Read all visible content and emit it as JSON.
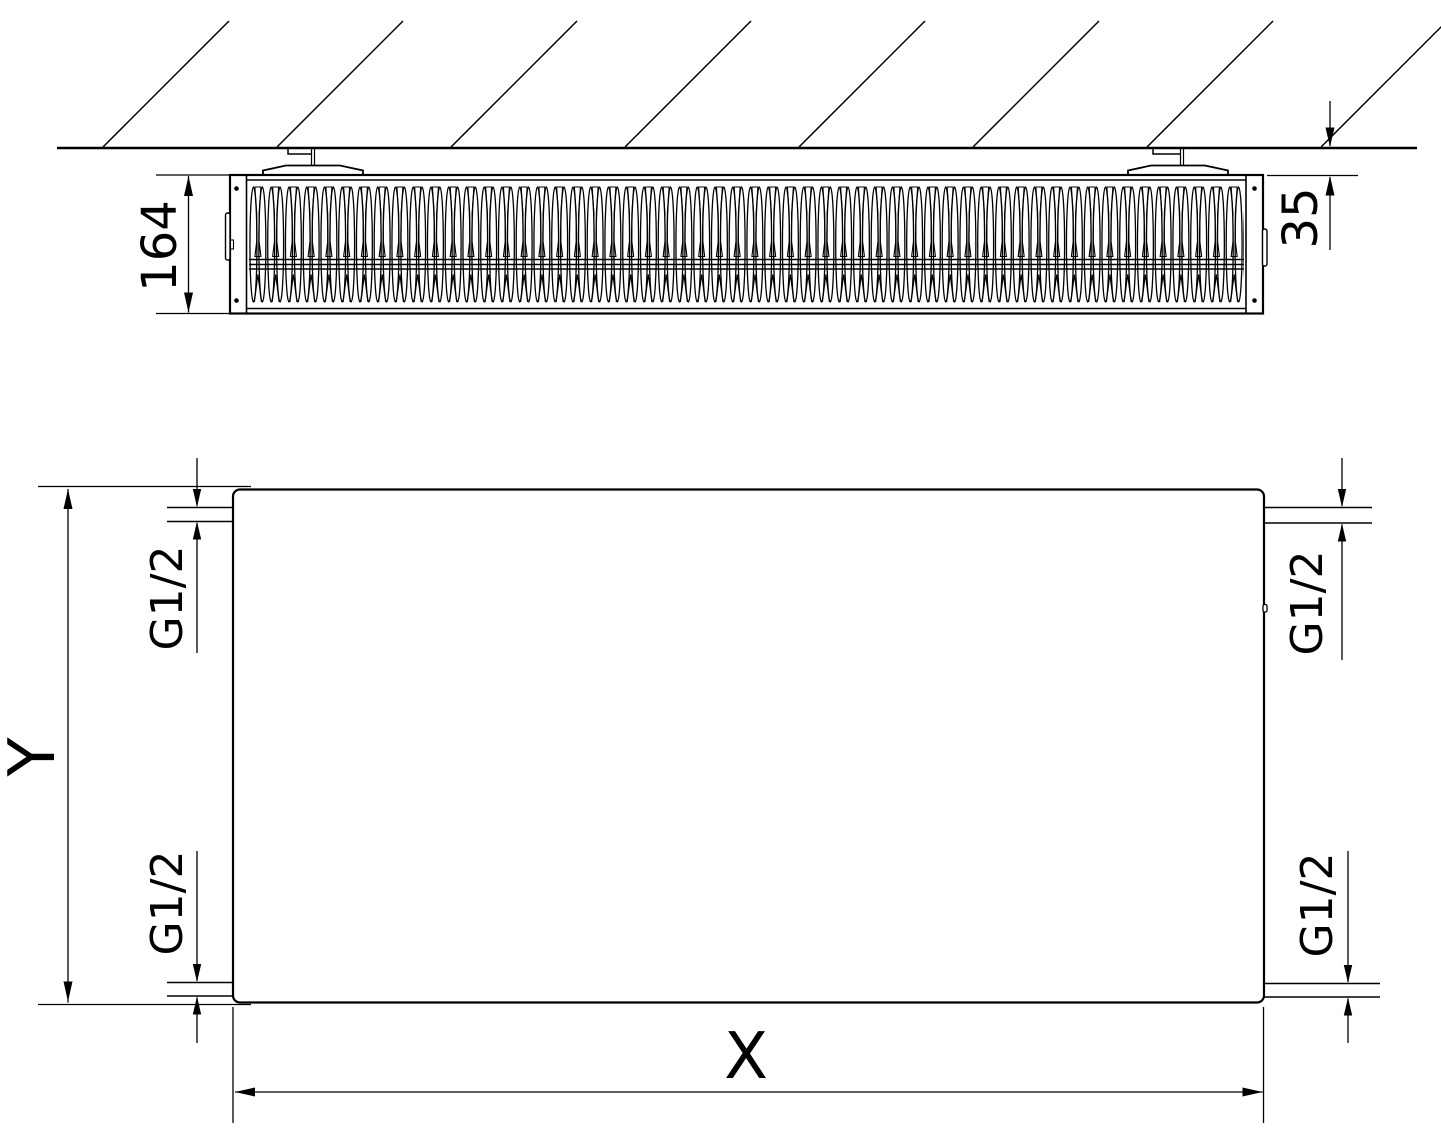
{
  "top_view": {
    "depth_dimension": "164",
    "wall_clearance_dimension": "35"
  },
  "front_view": {
    "height_dimension": "Y",
    "width_dimension": "X",
    "connections": {
      "top_left": "G1/2",
      "top_right": "G1/2",
      "bottom_left": "G1/2",
      "bottom_right": "G1/2"
    }
  },
  "colors": {
    "line": "#000000",
    "background": "#ffffff"
  }
}
